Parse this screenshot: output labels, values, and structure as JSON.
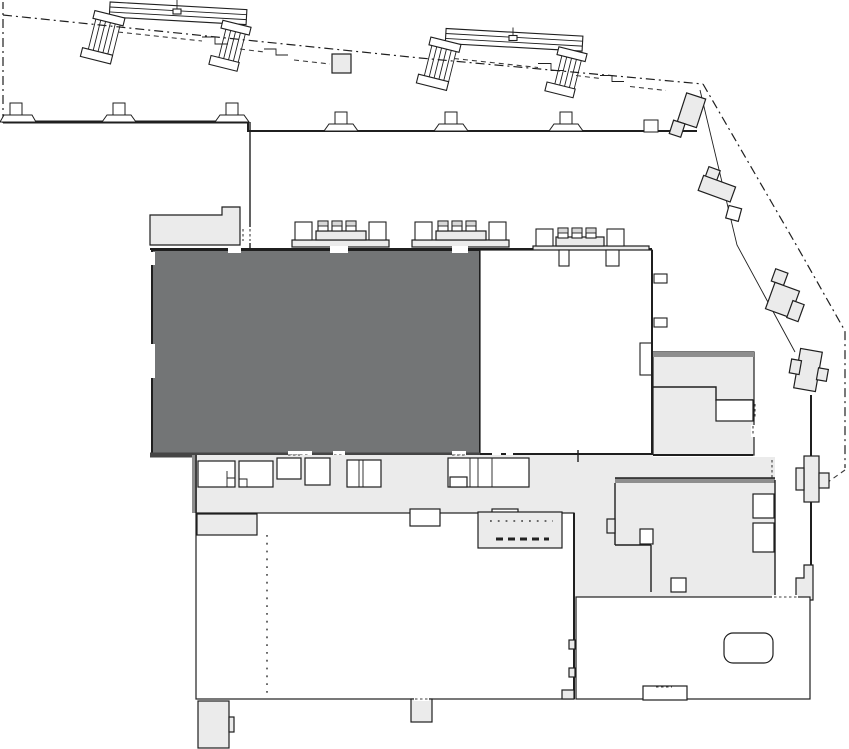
{
  "meta": {
    "kind": "mall-floor-plan",
    "canvas": {
      "width": 849,
      "height": 749
    },
    "description": "Architectural floor plan, no text labels; one unit highlighted dark gray"
  },
  "palette": {
    "background": "#ffffff",
    "outline": "#1f1f1f",
    "line_soft": "#3c3c3c",
    "wall_soft": "#8e8e8e",
    "room_light": "#ebebeb",
    "room_white": "#ffffff",
    "room_dark": "#737576"
  },
  "regions": [
    {
      "id": "top-concourse",
      "fill": "room_white",
      "note": "upper strip with two escalator bridges"
    },
    {
      "id": "highlighted-unit",
      "fill": "room_dark",
      "note": "large selected tenant space"
    },
    {
      "id": "adjacent-unit",
      "fill": "room_white",
      "note": "white unit right of highlighted unit"
    },
    {
      "id": "small-room-upper-left",
      "fill": "room_light"
    },
    {
      "id": "mid-right-rooms",
      "fill": "room_light"
    },
    {
      "id": "service-corridor",
      "fill": "room_light"
    },
    {
      "id": "southeast-block",
      "fill": "room_light"
    },
    {
      "id": "stair",
      "fill": "room_light"
    },
    {
      "id": "bottom-left-room",
      "fill": "room_white"
    },
    {
      "id": "bottom-right-room",
      "fill": "room_white"
    },
    {
      "id": "right-walkway",
      "fill": "room_white"
    }
  ],
  "icons": [
    {
      "id": "escalator-icon",
      "count": 2
    },
    {
      "id": "column-icon",
      "count": 6
    },
    {
      "id": "kiosk-row-icon",
      "count": 3
    },
    {
      "id": "stair-icon",
      "count": 1
    },
    {
      "id": "tub-table-icon",
      "count": 1
    }
  ]
}
